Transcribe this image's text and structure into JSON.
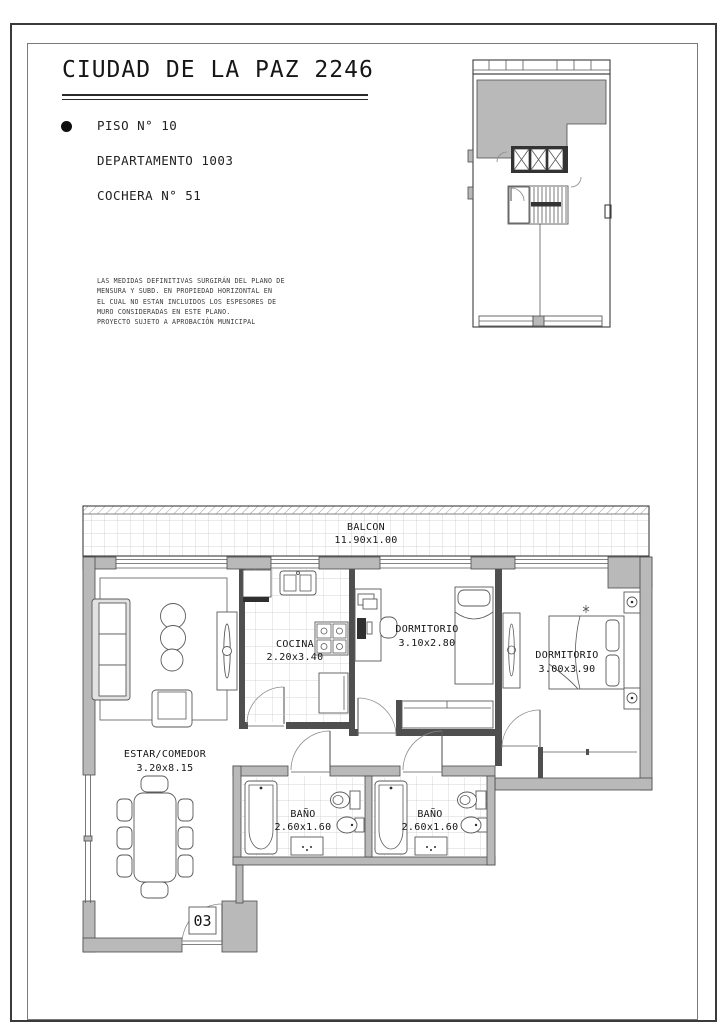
{
  "header": {
    "title": "CIUDAD DE LA PAZ 2246"
  },
  "unit_info": {
    "items": [
      "PISO N° 10",
      "DEPARTAMENTO 1003",
      "COCHERA N° 51"
    ]
  },
  "disclaimer": {
    "lines": [
      "LAS MEDIDAS DEFINITIVAS SURGIRÁN DEL PLANO DE",
      "MENSURA Y SUBD. EN PROPIEDAD HORIZONTAL EN",
      "EL CUAL NO ESTAN INCLUIDOS LOS ESPESORES DE",
      "MURO CONSIDERADAS EN ESTE PLANO.",
      "PROYECTO SUJETO A APROBACIÓN MUNICIPAL"
    ]
  },
  "floor_plan": {
    "rooms": [
      {
        "id": "balcon",
        "name": "BALCON",
        "dims": "11.90x1.00"
      },
      {
        "id": "cocina",
        "name": "COCINA",
        "dims": "2.20x3.40"
      },
      {
        "id": "dormitorio-1",
        "name": "DORMITORIO",
        "dims": "3.10x2.80"
      },
      {
        "id": "dormitorio-2",
        "name": "DORMITORIO",
        "dims": "3.00x3.90"
      },
      {
        "id": "estar-comedor",
        "name": "ESTAR/COMEDOR",
        "dims": "3.20x8.15"
      },
      {
        "id": "bano-1",
        "name": "BAÑO",
        "dims": "2.60x1.60"
      },
      {
        "id": "bano-2",
        "name": "BAÑO",
        "dims": "2.60x1.60"
      }
    ],
    "entry_label": "03"
  },
  "colors": {
    "wall": "#b9b9b9",
    "line": "#3d3d3d",
    "furn_line": "#5a5a5a",
    "grid": "#c6c6c6",
    "ink": "#1f1f1f"
  }
}
